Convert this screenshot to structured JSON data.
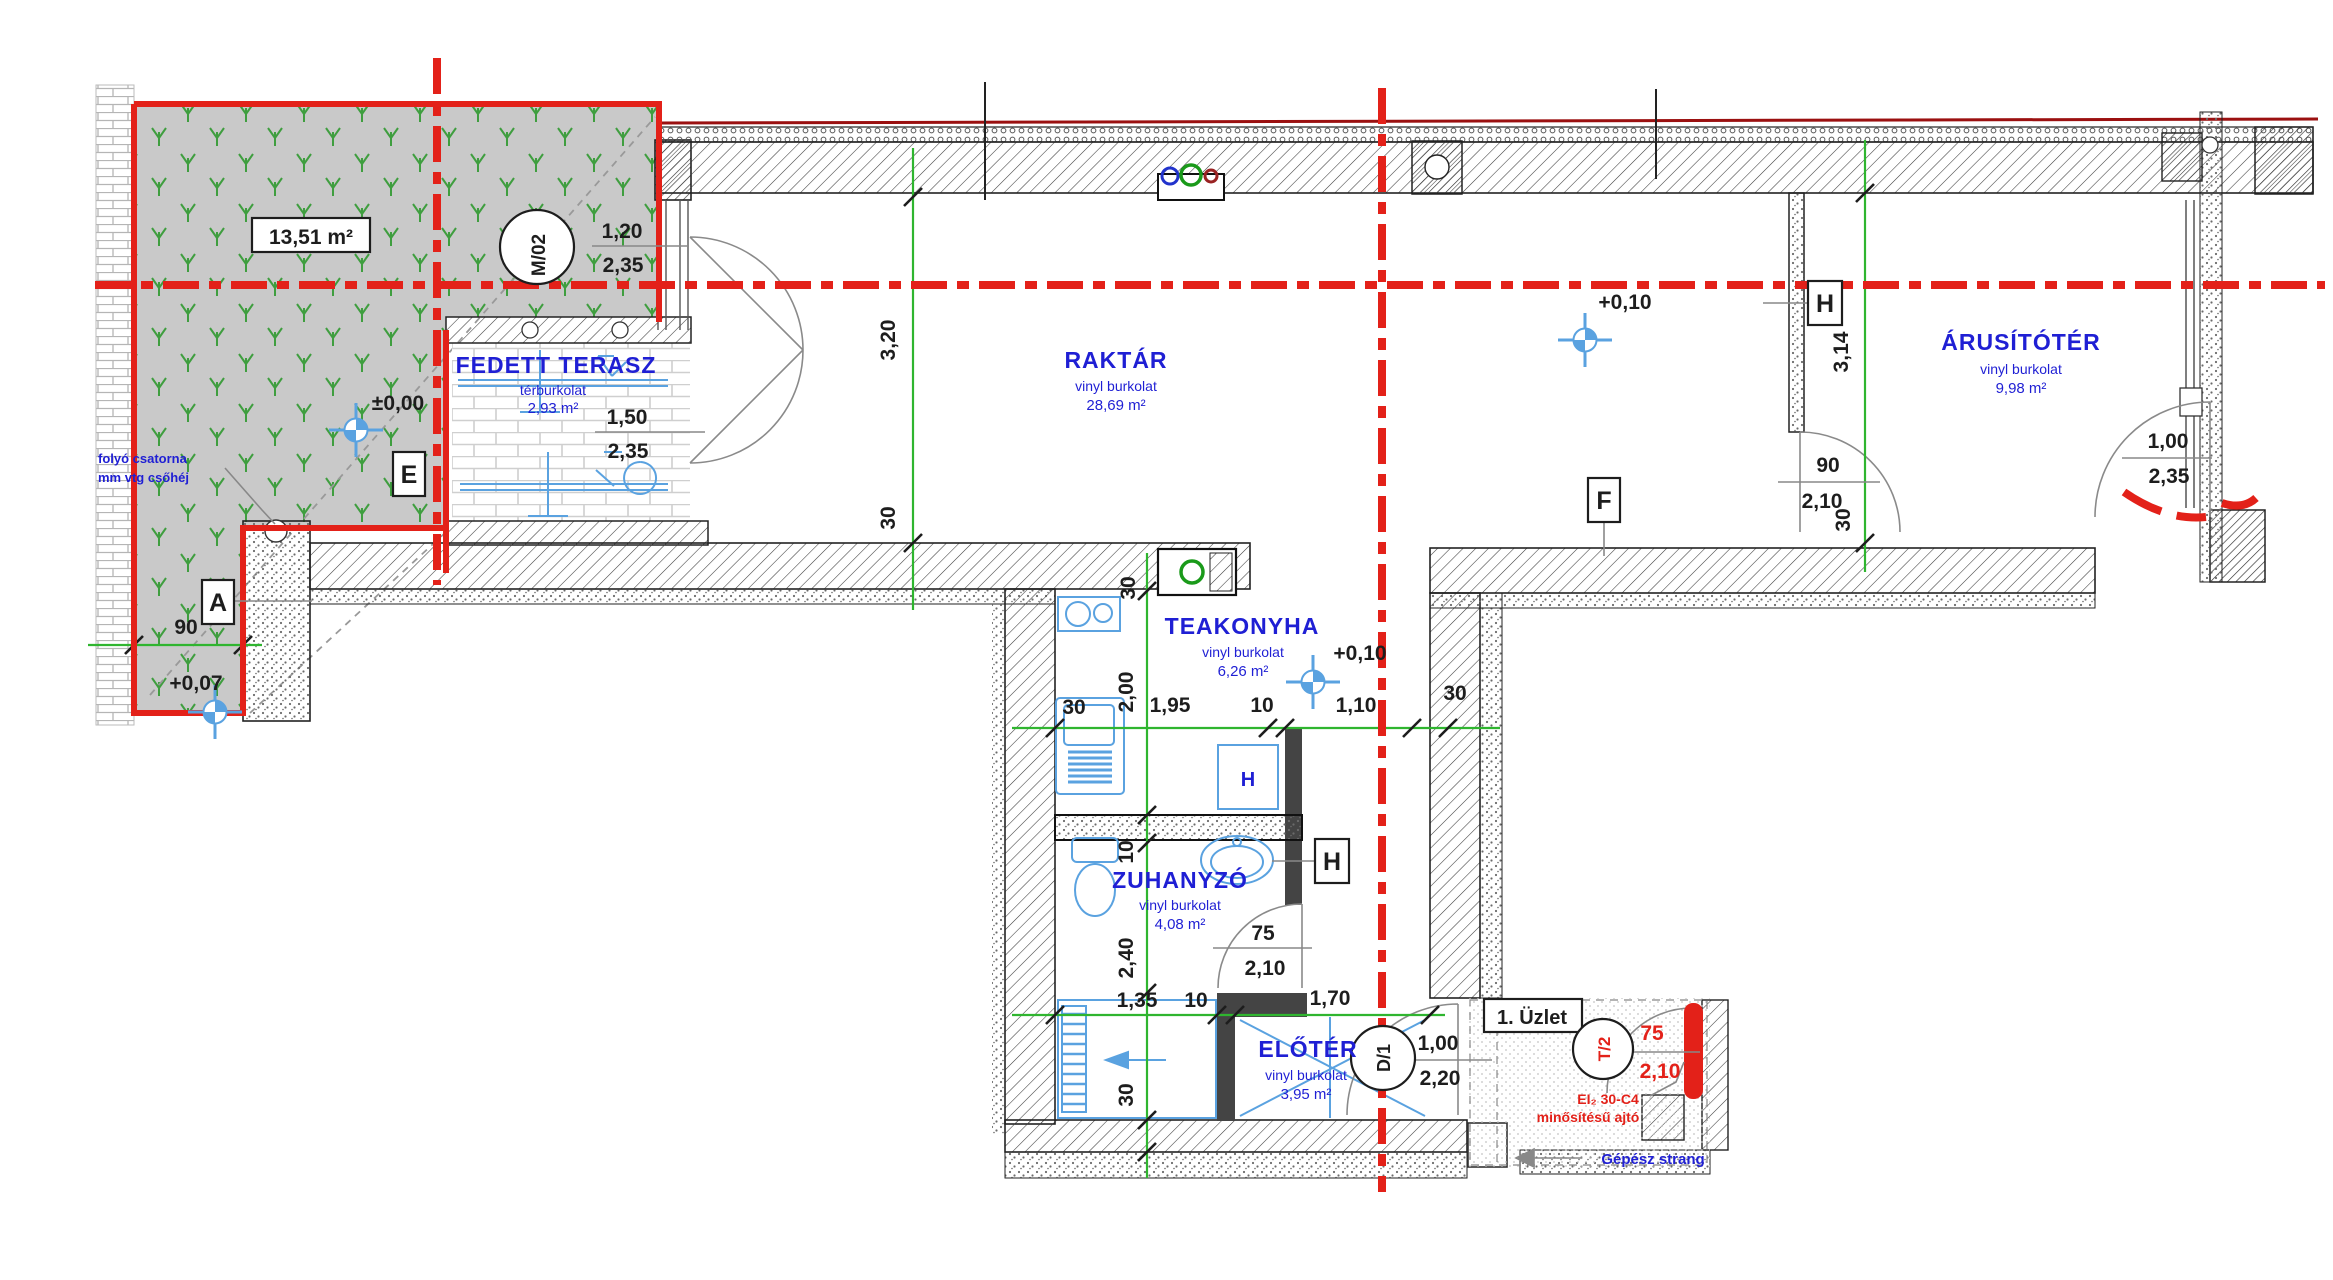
{
  "garden": {
    "area_boxed": "13,51 m²",
    "level": "+0,07",
    "strip_width": "90",
    "note_line1": "folyó csatorna",
    "note_line2": "mm vtg csőhéj"
  },
  "terrace": {
    "name": "FEDETT TERASZ",
    "finish": "térburkolat",
    "area": "2,93 m²",
    "level": "±0,00",
    "window_w": "1,50",
    "window_h": "2,35",
    "door_w": "1,20",
    "door_h": "2,35",
    "marker": "M/02"
  },
  "raktar": {
    "name": "RAKTÁR",
    "finish": "vinyl burkolat",
    "area": "28,69 m²",
    "level": "+0,10",
    "depth": "3,20",
    "wall": "30"
  },
  "arusitoter": {
    "name": "ÁRUSÍTÓTÉR",
    "finish": "vinyl burkolat",
    "area": "9,98 m²",
    "depth": "3,14",
    "wall": "30",
    "door_w": "90",
    "door_h": "2,10",
    "entry_w": "1,00",
    "entry_h": "2,35"
  },
  "teakonyha": {
    "name": "TEAKONYHA",
    "finish": "vinyl burkolat",
    "area": "6,26 m²",
    "level": "+0,10",
    "wall_left": "30",
    "width": "1,95",
    "partition": "10",
    "opening": "1,10",
    "wall_right": "30",
    "wall_top": "30",
    "depth": "2,00",
    "boiler": "H"
  },
  "zuhanyzo": {
    "name": "ZUHANYZÓ",
    "finish": "vinyl burkolat",
    "area": "4,08 m²",
    "partition": "10",
    "depth": "2,40",
    "door_w": "75",
    "door_h": "2,10"
  },
  "eloter": {
    "name": "ELŐTÉR",
    "finish": "vinyl burkolat",
    "area": "3,95 m²",
    "door_marker": "D/1",
    "door_w": "1,00",
    "door_h": "2,20",
    "left": "1,35",
    "partition": "10",
    "right": "1,70",
    "wall": "30"
  },
  "shop": {
    "label": "1. Üzlet",
    "door_marker": "T/2",
    "door_w": "75",
    "door_h": "2,10",
    "rating_line1": "EI₂ 30-C4",
    "rating_line2": "minősítésű ajtó",
    "mech_note": "Gépész strang"
  },
  "sections": {
    "a": "A",
    "e": "E",
    "f": "F",
    "h1": "H",
    "h2": "H"
  },
  "colors": {
    "grid_red": "#e32119",
    "dim_green": "#2fb52f",
    "room_blue": "#1f1fd4",
    "fixture_blue": "#5aa2e0",
    "grass_green": "#3f9e3f"
  }
}
